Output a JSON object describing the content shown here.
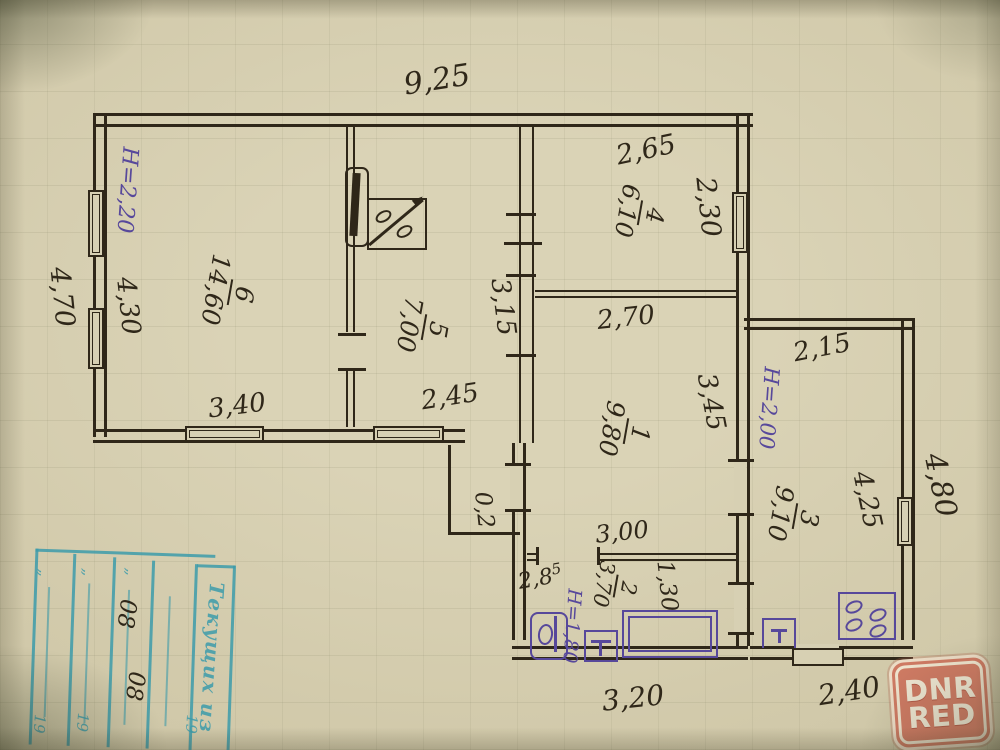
{
  "colors": {
    "paper": "#d3ccae",
    "ink": "#2f2719",
    "purple": "#57489b",
    "teal": "#3c9baa",
    "badge_bg": "#ce7a63",
    "badge_fg": "#eee6d2"
  },
  "dimensions": {
    "total_width": "9,25",
    "room4_w": "2,65",
    "room4_h": "2,30",
    "left_outer": "4,70",
    "room6_h": "4,30",
    "room6_w": "3,40",
    "room5_w": "2,45",
    "corridor": "3,15",
    "room1_w": "2,70",
    "room1_h": "3,45",
    "annex_w": "2,15",
    "annex_h": "4,25",
    "annex_outer": "4,80",
    "hall_w": "3,00",
    "bath_w": "2,8",
    "bath_w_sup": "5",
    "bath_l": "1,30",
    "bottom_w": "3,20",
    "annex_bottom_w": "2,40",
    "step": "0,2"
  },
  "rooms": {
    "r1": {
      "num": "1",
      "area": "9,80"
    },
    "r2": {
      "num": "2",
      "area": "3,70"
    },
    "r3": {
      "num": "3",
      "area": "9,10"
    },
    "r4": {
      "num": "4",
      "area": "6,10"
    },
    "r5": {
      "num": "5",
      "area": "7,00"
    },
    "r6": {
      "num": "6",
      "area": "14,60"
    }
  },
  "heights": {
    "main": "H=2,20",
    "annex": "H=2,00",
    "bath": "H=1,80"
  },
  "stamp": {
    "title": "Текущих из",
    "quote": "„",
    "year": "19",
    "entries": [
      "08",
      "08"
    ]
  },
  "watermark": {
    "line1": "DNR",
    "line2": "RED"
  }
}
